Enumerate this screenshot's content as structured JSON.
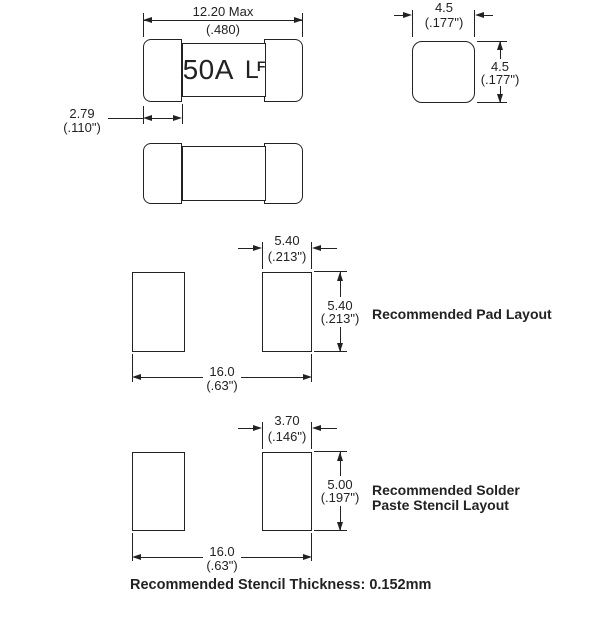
{
  "top_view": {
    "marking": {
      "current": "50A",
      "logo_l": "L",
      "logo_f": "F"
    },
    "length": {
      "mm": "12.20 Max",
      "in": "(.480)"
    },
    "cap": {
      "mm": "2.79",
      "in": "(.110\")"
    }
  },
  "end_view": {
    "width": {
      "mm": "4.5",
      "in": "(.177\")"
    },
    "height": {
      "mm": "4.5",
      "in": "(.177\")"
    }
  },
  "pad": {
    "label": "Recommended Pad Layout",
    "width": {
      "mm": "5.40",
      "in": "(.213\")"
    },
    "height": {
      "mm": "5.40",
      "in": "(.213\")"
    },
    "span": {
      "mm": "16.0",
      "in": "(.63\")"
    }
  },
  "stencil": {
    "label_line1": "Recommended Solder",
    "label_line2": "Paste Stencil Layout",
    "width": {
      "mm": "3.70",
      "in": "(.146\")"
    },
    "height": {
      "mm": "5.00",
      "in": "(.197\")"
    },
    "span": {
      "mm": "16.0",
      "in": "(.63\")"
    }
  },
  "note": "Recommended Stencil Thickness: 0.152mm",
  "colors": {
    "ink": "#222222",
    "background": "#ffffff"
  }
}
